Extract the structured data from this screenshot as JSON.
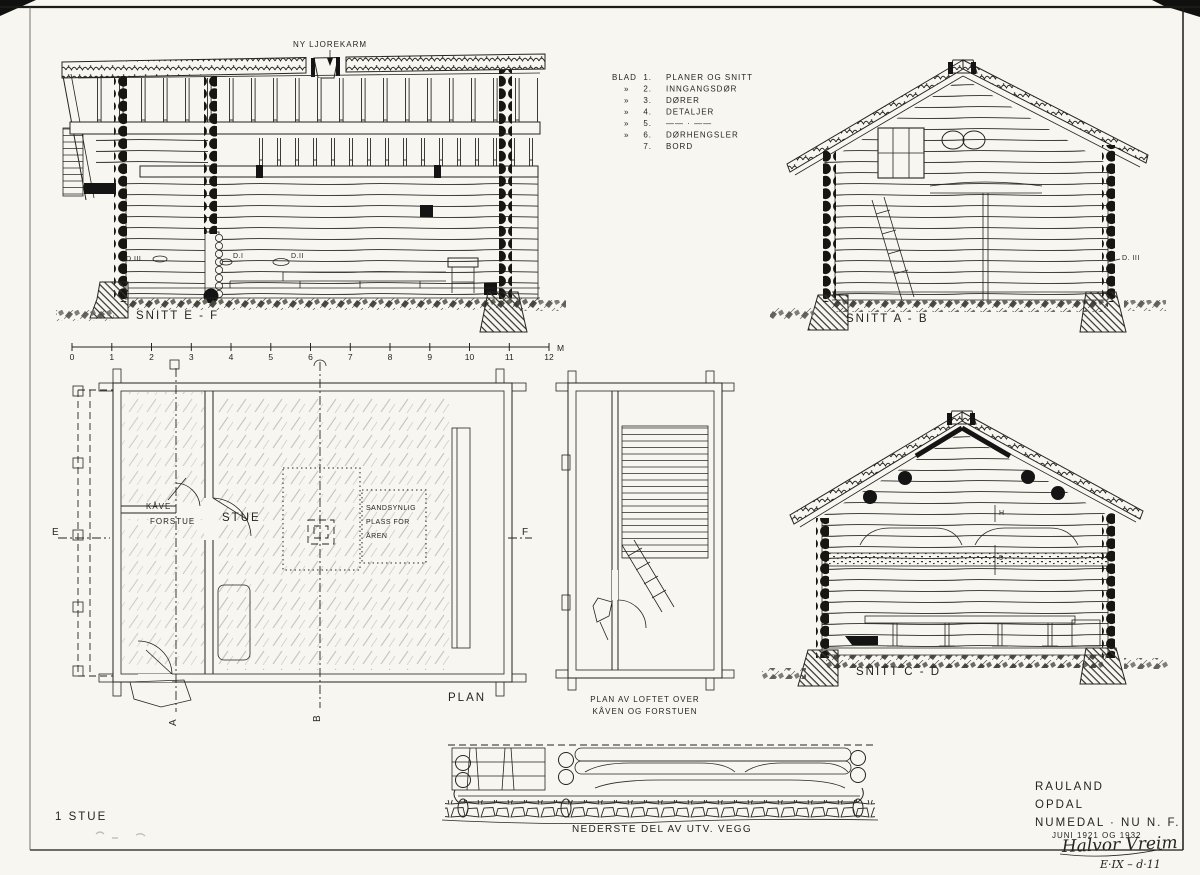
{
  "sheet": {
    "paper_color": "#f7f6f1",
    "ink_color": "#26251f"
  },
  "ljore_label": "NY LJOREKARM",
  "legend": {
    "rows": [
      {
        "prefix": "BLAD",
        "num": "1.",
        "label": "PLANER OG SNITT"
      },
      {
        "prefix": "»",
        "num": "2.",
        "label": "INNGANGSDØR"
      },
      {
        "prefix": "»",
        "num": "3.",
        "label": "DØRER"
      },
      {
        "prefix": "»",
        "num": "4.",
        "label": "DETALJER"
      },
      {
        "prefix": "»",
        "num": "5.",
        "label": "—— · ——"
      },
      {
        "prefix": "»",
        "num": "6.",
        "label": "DØRHENGSLER"
      },
      {
        "prefix": "",
        "num": "7.",
        "label": "BORD"
      }
    ]
  },
  "snitt_ef": {
    "title": "SNITT  E - F",
    "detail_d3": "D.III",
    "detail_d1": "D.I",
    "detail_d2": "D.II",
    "scale": {
      "ticks": [
        "0",
        "1",
        "2",
        "3",
        "4",
        "5",
        "6",
        "7",
        "8",
        "9",
        "10",
        "11",
        "12"
      ],
      "unit": "M"
    }
  },
  "snitt_ab": {
    "title": "SNITT  A - B",
    "detail_d3": "D. III"
  },
  "snitt_cd": {
    "title": "SNITT  C - D",
    "mark_top": "H",
    "mark_bottom": "5"
  },
  "plan": {
    "title": "PLAN",
    "room_kave": "KÅVE",
    "room_forstue": "FORSTUE",
    "room_stue": "STUE",
    "aren_line1": "SANDSYNLIG",
    "aren_line2": "PLASS FOR",
    "aren_line3": "ÅREN",
    "marker_e": "E",
    "marker_f": "F",
    "marker_a": "A",
    "marker_b": "B"
  },
  "loft_plan": {
    "title_line1": "PLAN  AV  LOFTET  OVER",
    "title_line2": "KÅVEN  OG  FORSTUEN"
  },
  "wall_detail": {
    "title": "NEDERSTE  DEL  AV  UTV.  VEGG"
  },
  "title_block": {
    "place1": "RAULAND",
    "place2": "OPDAL",
    "place3": "NUMEDAL · NU   N. F.",
    "date": "JUNI  1921  OG  1932",
    "signature": "Halvor Vreim",
    "ref": "E·IX – d·11"
  },
  "sheet_no": "1 STUE"
}
